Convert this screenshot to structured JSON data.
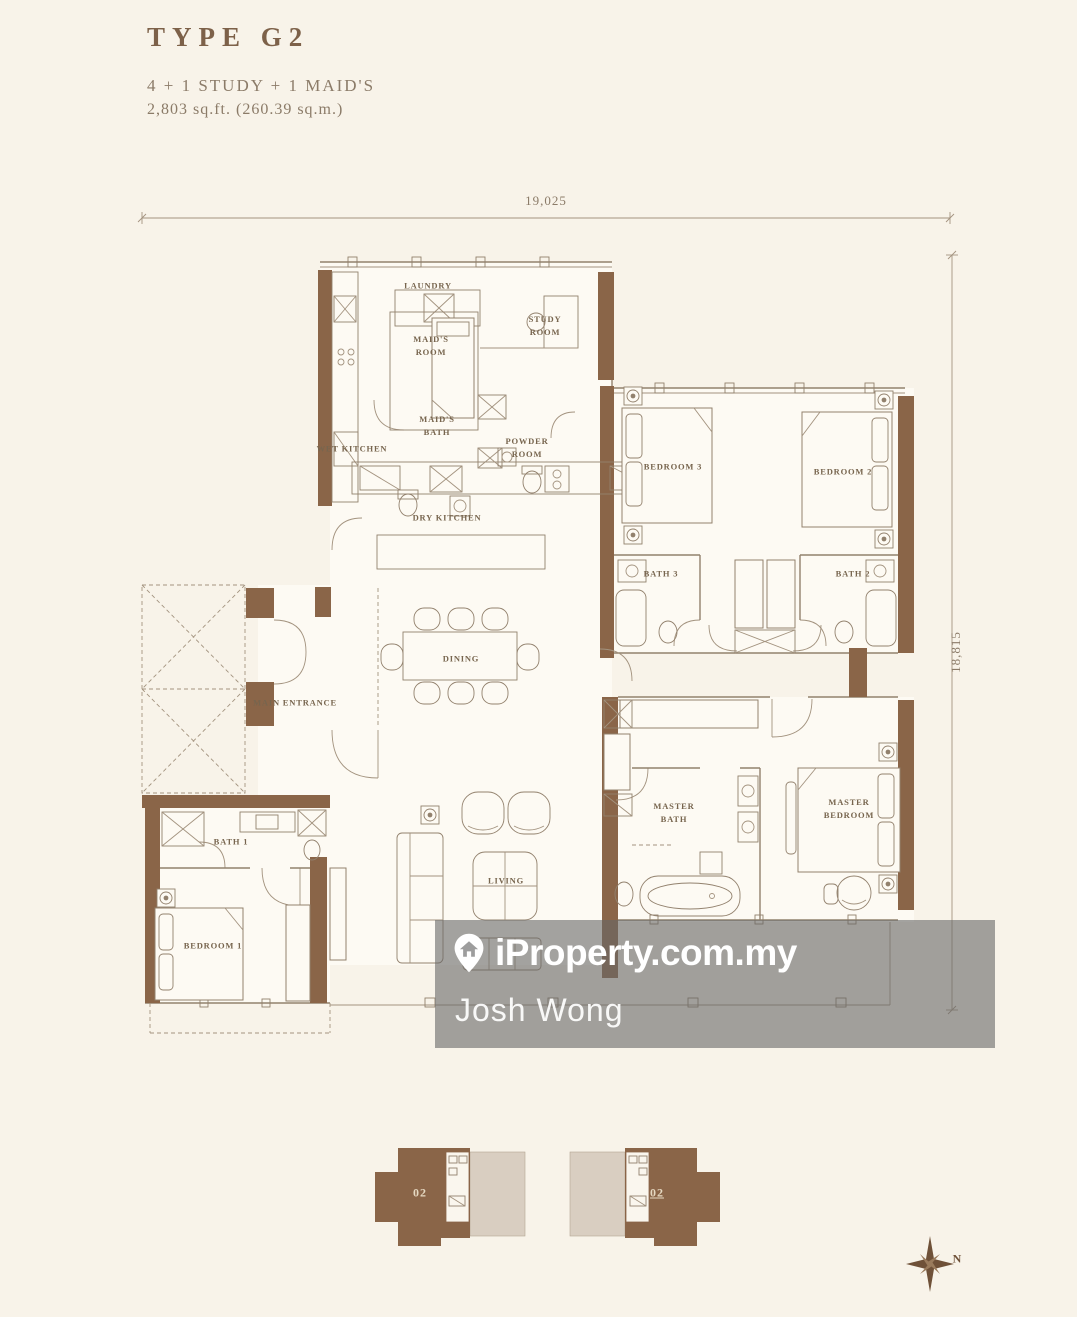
{
  "header": {
    "title": "TYPE G2",
    "configuration": "4 + 1 STUDY + 1 MAID'S",
    "area": "2,803 sq.ft.  (260.39 sq.m.)"
  },
  "dimensions": {
    "width": "19,025",
    "height": "18,815"
  },
  "rooms": {
    "laundry": "LAUNDRY",
    "maids_room": "MAID'S ROOM",
    "study_room": "STUDY ROOM",
    "wet_kitchen": "WET KITCHEN",
    "maids_bath": "MAID'S BATH",
    "powder_room": "POWDER ROOM",
    "dry_kitchen": "DRY KITCHEN",
    "dining": "DINING",
    "main_entrance": "MAIN ENTRANCE",
    "living": "LIVING",
    "bath_1": "BATH 1",
    "bedroom_1": "BEDROOM 1",
    "bedroom_2": "BEDROOM 2",
    "bedroom_3": "BEDROOM 3",
    "bath_2": "BATH 2",
    "bath_3": "BATH 3",
    "master_bath": "MASTER BATH",
    "master_bedroom": "MASTER BEDROOM"
  },
  "watermark": {
    "brand": "iProperty.com.my",
    "agent": "Josh Wong"
  },
  "key_plan": {
    "left_unit": "02",
    "right_unit": "02"
  },
  "compass": {
    "north": "N"
  },
  "colors": {
    "wall_brown": "#8a6548",
    "line_brown": "#92816d",
    "label_brown": "#77654e",
    "title_brown": "#7d6149",
    "page_background": "#f8f3e9",
    "room_background": "#fdfaf3",
    "keyplan_beige": "#d9cec1",
    "watermark_overlay": "#a3a3a3"
  }
}
